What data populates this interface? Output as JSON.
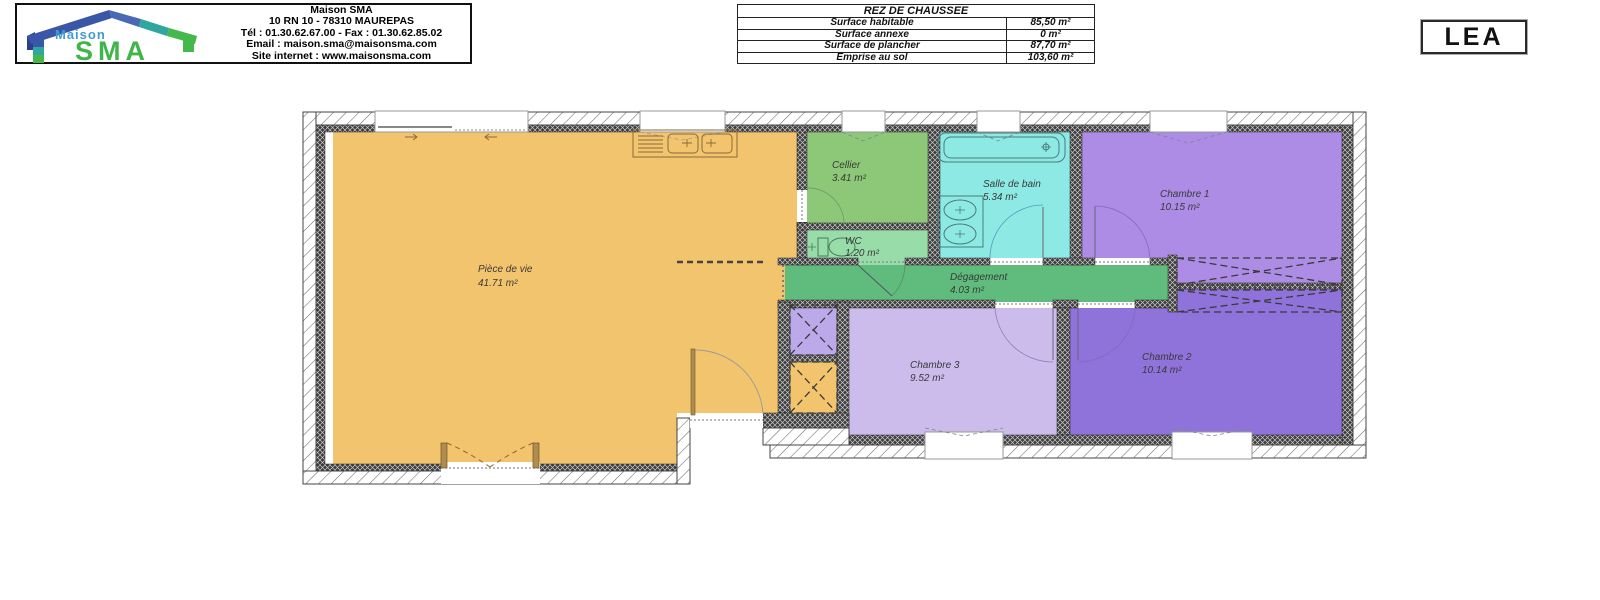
{
  "header": {
    "logo": {
      "brand_top": "Maison",
      "brand_main": "SMA"
    },
    "company": {
      "name": "Maison SMA",
      "address": "10 RN 10 - 78310 MAUREPAS",
      "phone_fax": "Tél : 01.30.62.67.00 - Fax : 01.30.62.85.02",
      "email": "Email : maison.sma@maisonsma.com",
      "website": "Site internet : www.maisonsma.com"
    },
    "surface_table": {
      "title": "REZ DE CHAUSSEE",
      "rows": [
        {
          "label": "Surface habitable",
          "value": "85,50 m²"
        },
        {
          "label": "Surface annexe",
          "value": "0 m²"
        },
        {
          "label": "Surface de plancher",
          "value": "87,70 m²"
        },
        {
          "label": "Emprise au sol",
          "value": "103,60 m²"
        }
      ]
    },
    "client_label": "LEA"
  },
  "floor_plan": {
    "level_name": "REZ DE CHAUSSEE",
    "rooms": [
      {
        "name": "Pièce de vie",
        "area": "41.71 m²"
      },
      {
        "name": "Cellier",
        "area": "3.41 m²"
      },
      {
        "name": "WC",
        "area": "1.20 m²"
      },
      {
        "name": "Salle de bain",
        "area": "5.34 m²"
      },
      {
        "name": "Chambre 1",
        "area": "10.15 m²"
      },
      {
        "name": "Dégagement",
        "area": "4.03 m²"
      },
      {
        "name": "Chambre 3",
        "area": "9.52 m²"
      },
      {
        "name": "Chambre 2",
        "area": "10.14 m²"
      }
    ],
    "colors": {
      "living": "#F3C46E",
      "cellier": "#8CC878",
      "wc": "#97DCA9",
      "bathroom": "#8DE9E3",
      "bedroom1": "#AC8CE4",
      "hallway": "#5FBC7C",
      "bedroom3": "#CBBCEC",
      "bedroom2": "#8F72DA",
      "closet_purple": "#BCA9E9",
      "logo_blue_dark": "#2B3F8F",
      "logo_blue": "#3A57A7",
      "logo_teal": "#2FA7A0",
      "logo_green": "#45B84C",
      "logo_maison_text": "#3F9CCB",
      "logo_sma_text": "#3FB54A"
    }
  }
}
